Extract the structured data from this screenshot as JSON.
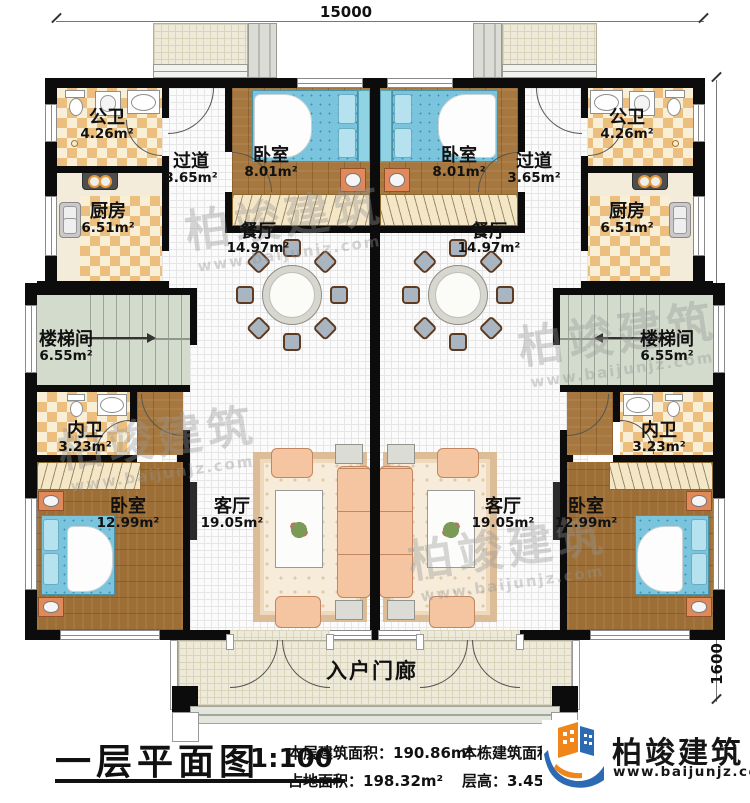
{
  "plan": {
    "title": "一层平面图",
    "scale": "1:100",
    "stats": {
      "floor_area": "本层建筑面积：190.86m²",
      "land_area": "占地面积：198.32m²",
      "building_area": "本栋建筑面积：",
      "floor_height": "层高：3.45m"
    }
  },
  "dimensions": {
    "total_width": "15000",
    "main_depth": "11800",
    "porch_depth": "1600"
  },
  "rooms": {
    "gongwei": {
      "name": "公卫",
      "area": "4.26m²"
    },
    "guodao": {
      "name": "过道",
      "area": "3.65m²"
    },
    "woshi_top": {
      "name": "卧室",
      "area": "8.01m²"
    },
    "chufang": {
      "name": "厨房",
      "area": "6.51m²"
    },
    "canting": {
      "name": "餐厅",
      "area": "14.97m²"
    },
    "loutijian": {
      "name": "楼梯间",
      "area": "6.55m²"
    },
    "neiwei": {
      "name": "内卫",
      "area": "3.23m²"
    },
    "woshi_bottom": {
      "name": "卧室",
      "area": "12.99m²"
    },
    "keting": {
      "name": "客厅",
      "area": "19.05m²"
    },
    "porch": {
      "name": "入户门廊"
    }
  },
  "brand": {
    "name": "柏竣建筑",
    "url": "www.baijunjz.com"
  },
  "watermark": {
    "text": "柏竣建筑",
    "url": "www.baijunjz.com"
  },
  "colors": {
    "brand_blue": "#2d6ab4",
    "brand_orange": "#f08519",
    "wall": "#0c0c0c"
  }
}
